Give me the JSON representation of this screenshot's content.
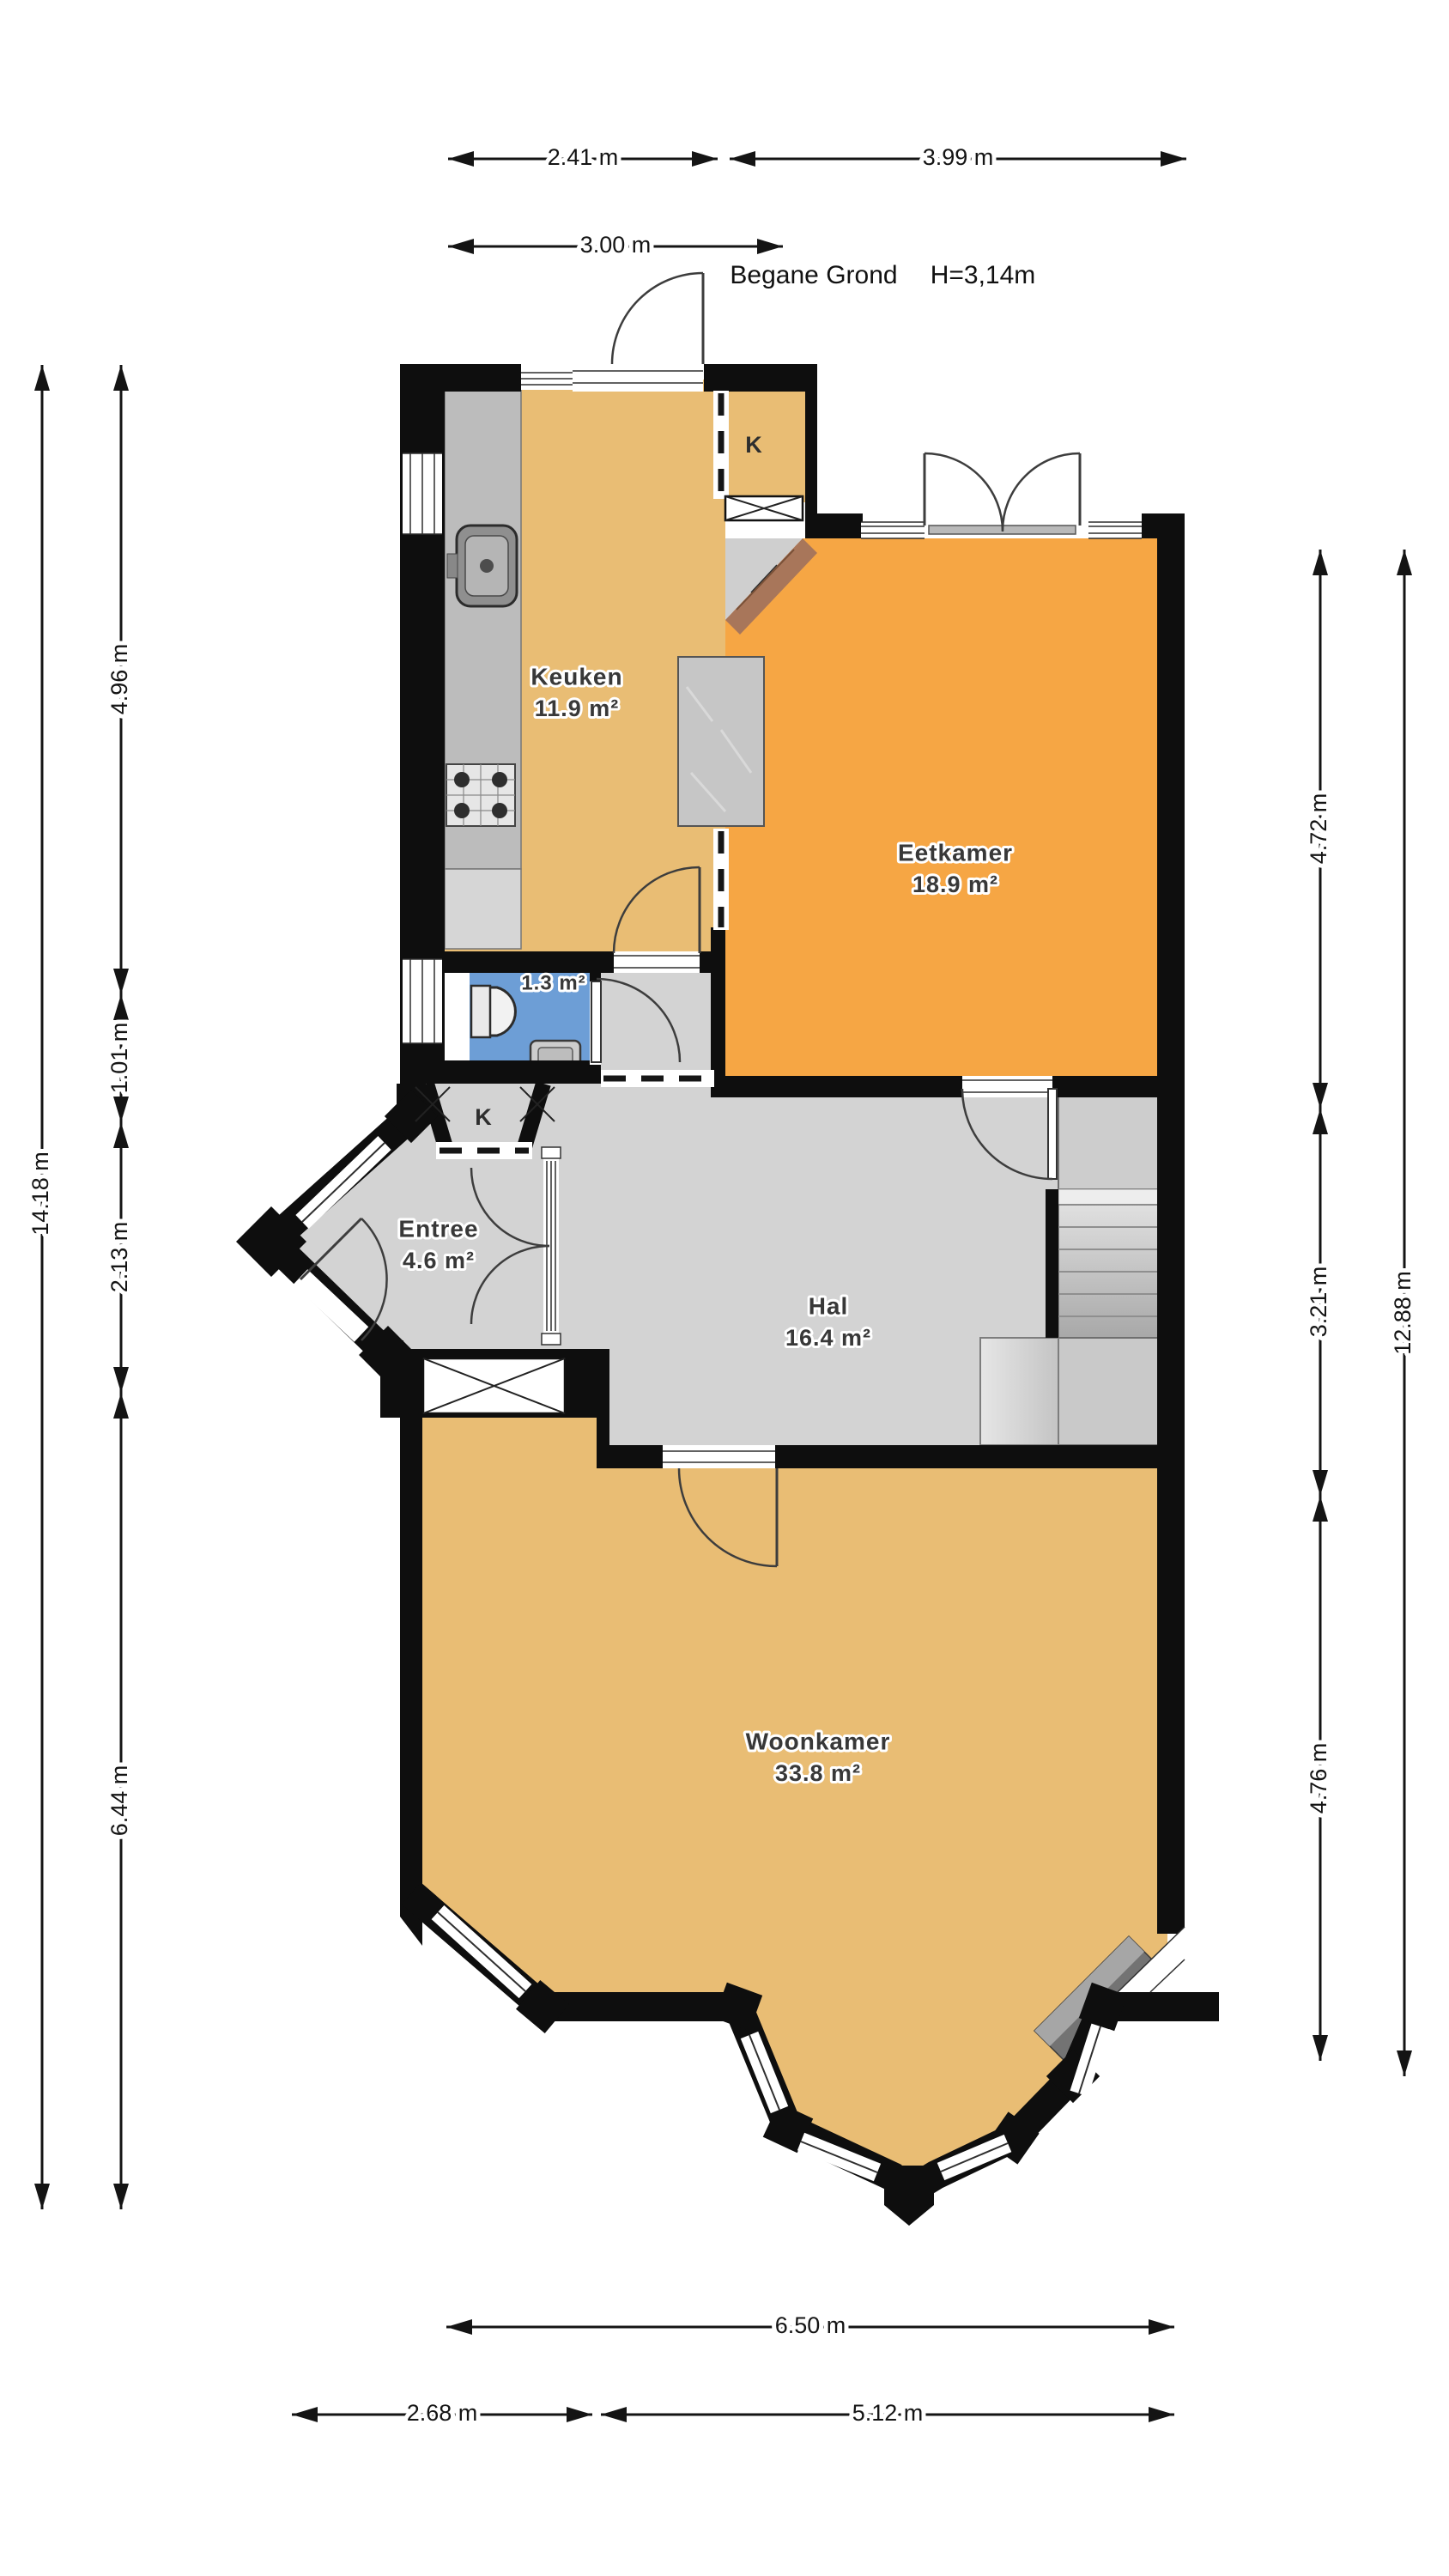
{
  "plan": {
    "title": "Begane Grond",
    "ceiling_height": "H=3,14m",
    "rooms": [
      {
        "id": "keuken",
        "name": "Keuken",
        "area": "11.9 m²"
      },
      {
        "id": "eetkamer",
        "name": "Eetkamer",
        "area": "18.9 m²"
      },
      {
        "id": "hal",
        "name": "Hal",
        "area": "16.4 m²"
      },
      {
        "id": "entree",
        "name": "Entree",
        "area": "4.6 m²"
      },
      {
        "id": "woonkamer",
        "name": "Woonkamer",
        "area": "33.8 m²"
      },
      {
        "id": "toilet",
        "name": "",
        "area": "1.3 m²"
      }
    ],
    "closets": [
      "K",
      "K"
    ],
    "dimensions": {
      "top": [
        "2.41 m",
        "3.99 m",
        "3.00 m"
      ],
      "left": [
        "4.96 m",
        "1.01 m",
        "2.13 m",
        "6.44 m",
        "14.18 m"
      ],
      "right": [
        "4.72 m",
        "3.21 m",
        "4.76 m",
        "12.88 m"
      ],
      "bottom": [
        "6.50 m",
        "2.68 m",
        "5.12 m"
      ]
    }
  },
  "colors": {
    "c-wall": "#0e0e0e",
    "c-kitchen": "#e9bd74",
    "c-dining": "#f6a644",
    "c-living": "#e9bd74",
    "c-hall": "#d3d3d3",
    "c-toilet": "#6d9ed6",
    "c-counter": "#bcbcbc",
    "c-counter2": "#d6d6d6",
    "c-island": "#c6c6c6",
    "c-brick": "#a8765a",
    "c-chimney": "#737373",
    "c-line": "#3d3d3d",
    "c-dim": "#141414",
    "c-label": "#383838"
  }
}
